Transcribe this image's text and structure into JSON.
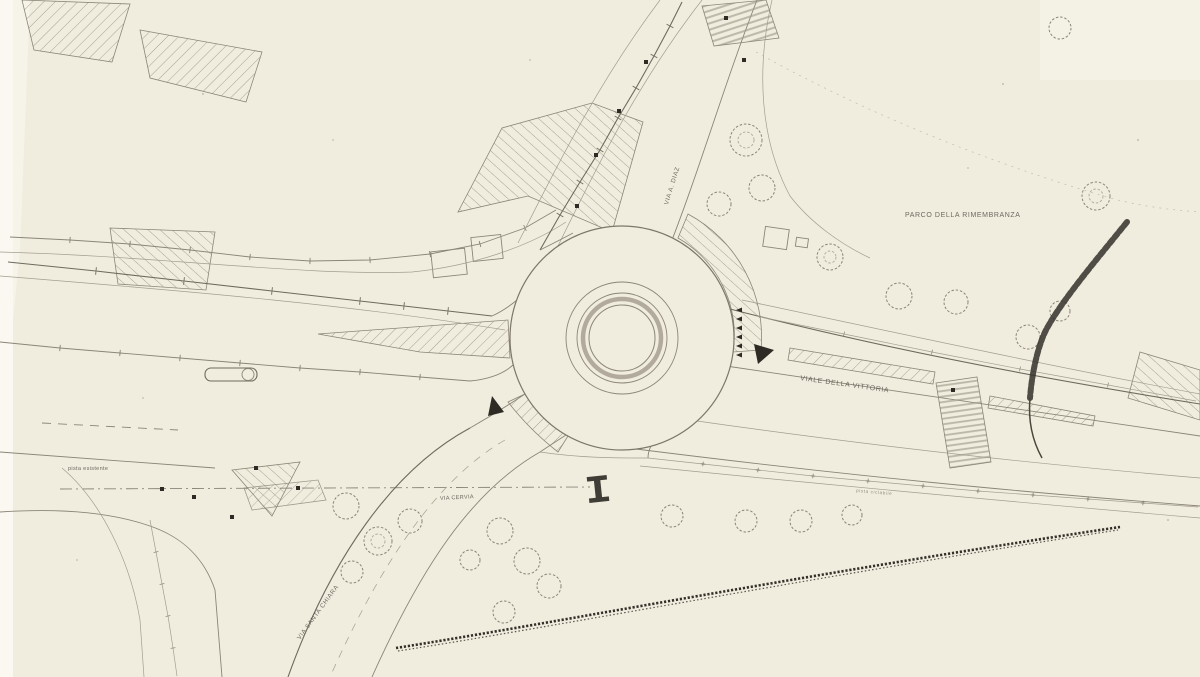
{
  "labels": {
    "park": "PARCO DELLA RIMEMBRANZA",
    "viale_vittoria": "VIALE DELLA VITTORIA",
    "via_diaz": "VIA A. DIAZ",
    "pista_esistente": "pista esistente",
    "via_cervia": "VIA CERVIA",
    "via_santa_chiara": "VIA SANTA CHIARA",
    "pista_ciclabile": "pista ciclabile"
  },
  "colors": {
    "paper": "#f0edde",
    "ink": "#8b8577",
    "ink_dark": "#2e2b24",
    "center_ring": "#a39a8c"
  }
}
